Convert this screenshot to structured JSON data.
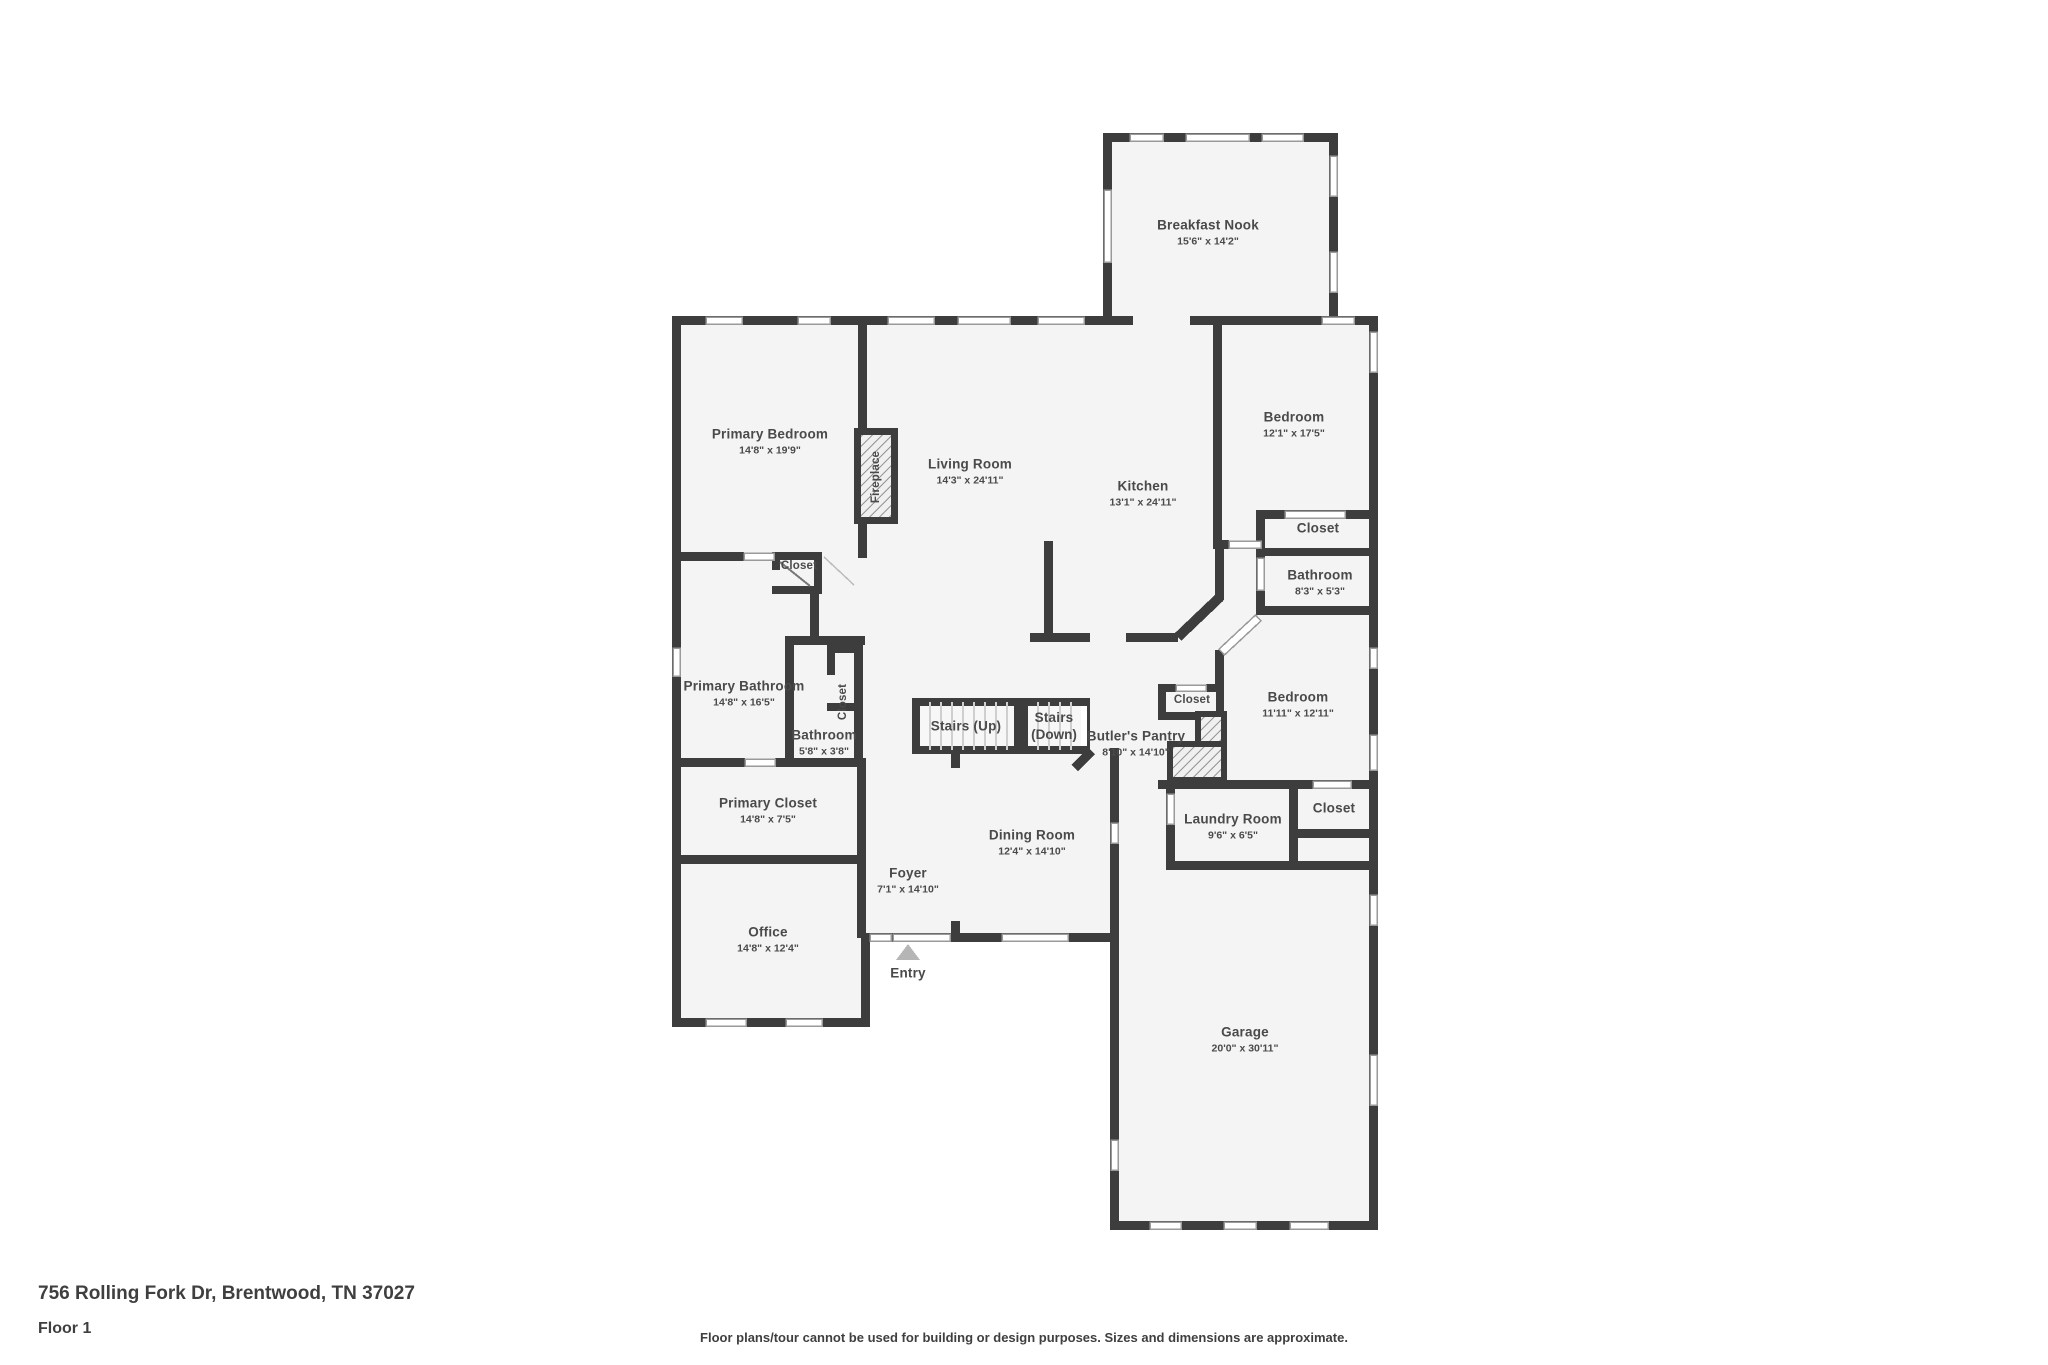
{
  "page": {
    "address": "756 Rolling Fork Dr, Brentwood, TN 37027",
    "floor_label": "Floor 1",
    "disclaimer": "Floor plans/tour cannot be used for building or design purposes. Sizes and dimensions are approximate."
  },
  "colors": {
    "wall": "#3d3d3d",
    "floor": "#f4f4f4",
    "text": "#4a4a4a",
    "window_border": "#9a9a9a",
    "entry_arrow": "#b5b5b5",
    "hatch_line": "#8f8f8f"
  },
  "rooms": [
    {
      "name": "Breakfast Nook",
      "dims": "15'6\" x 14'2\""
    },
    {
      "name": "Primary Bedroom",
      "dims": "14'8\" x 19'9\""
    },
    {
      "name": "Living Room",
      "dims": "14'3\" x 24'11\""
    },
    {
      "name": "Kitchen",
      "dims": "13'1\" x 24'11\""
    },
    {
      "name": "Bedroom",
      "dims": "12'1\" x 17'5\""
    },
    {
      "name": "Closet",
      "dims": ""
    },
    {
      "name": "Bathroom",
      "dims": "8'3\" x 5'3\""
    },
    {
      "name": "Closet",
      "dims": ""
    },
    {
      "name": "Primary Bathroom",
      "dims": "14'8\" x 16'5\""
    },
    {
      "name": "Closet",
      "dims": ""
    },
    {
      "name": "Bathroom",
      "dims": "5'8\" x 3'8\""
    },
    {
      "name": "Stairs (Up)",
      "dims": ""
    },
    {
      "name": "Stairs",
      "dims": "(Down)"
    },
    {
      "name": "Butler's Pantry",
      "dims": "8'10\" x 14'10\""
    },
    {
      "name": "Closet",
      "dims": ""
    },
    {
      "name": "Bedroom",
      "dims": "11'11\" x 12'11\""
    },
    {
      "name": "Laundry Room",
      "dims": "9'6\" x 6'5\""
    },
    {
      "name": "Closet",
      "dims": ""
    },
    {
      "name": "Primary Closet",
      "dims": "14'8\" x 7'5\""
    },
    {
      "name": "Dining Room",
      "dims": "12'4\" x 14'10\""
    },
    {
      "name": "Foyer",
      "dims": "7'1\" x 14'10\""
    },
    {
      "name": "Office",
      "dims": "14'8\" x 12'4\""
    },
    {
      "name": "Entry",
      "dims": ""
    },
    {
      "name": "Garage",
      "dims": "20'0\" x 30'11\""
    },
    {
      "name": "Fireplace",
      "dims": ""
    }
  ]
}
